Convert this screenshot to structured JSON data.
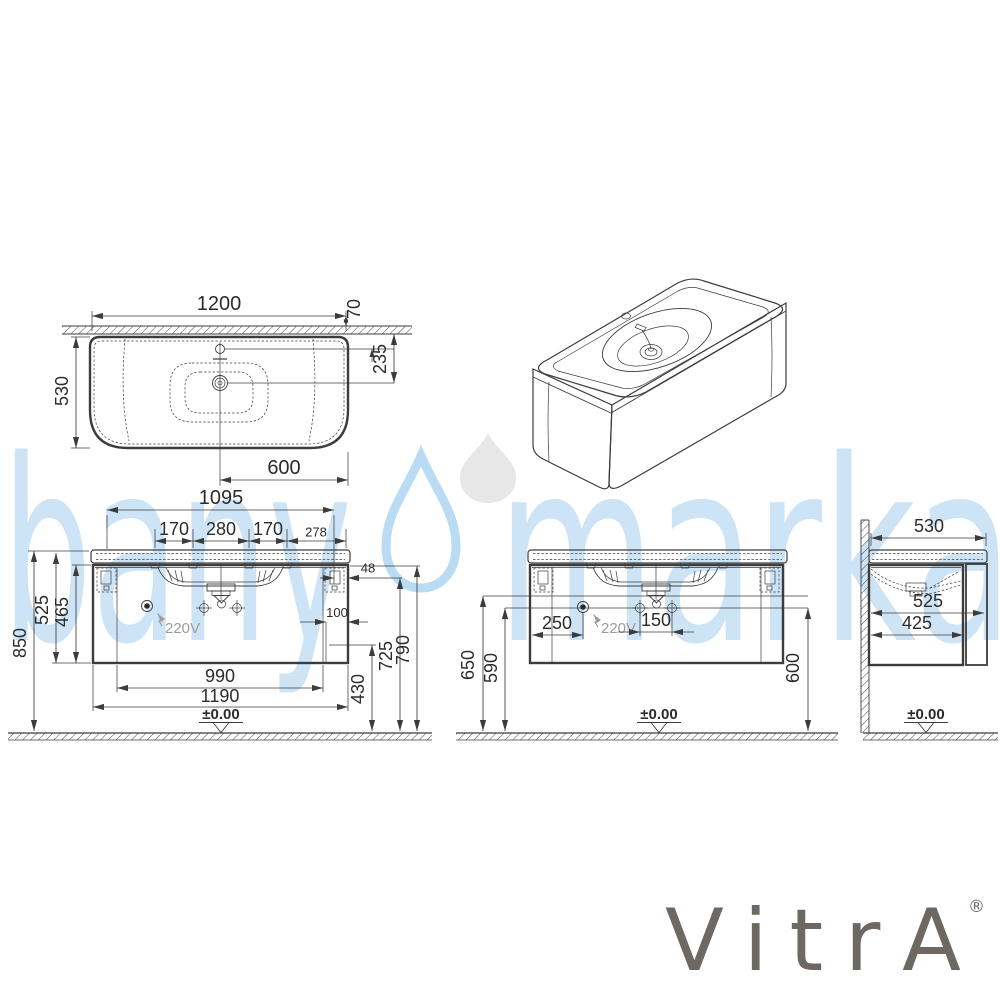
{
  "watermark": {
    "left": "bany",
    "right": "marka"
  },
  "brand": {
    "name": "VitrA",
    "registered": "®"
  },
  "colors": {
    "line": "#3c3c3c",
    "dim_text": "#2b2b2b",
    "muted_text": "#9d9d9d",
    "watermark_blue": "#cde4f7",
    "watermark_drop_outline": "#b9dbf4",
    "watermark_drop_gray": "#e7e7e7",
    "logo_gray": "#6d6962"
  },
  "top_view": {
    "width": "1200",
    "rim_to_wall": "70",
    "depth": "530",
    "drain_to_wall": "235",
    "drain_to_edge": "600"
  },
  "front_view": {
    "fixing_span": "1095",
    "hole_left": "170",
    "hole_mid": "280",
    "hole_right": "170",
    "hole_to_edge": "278",
    "edge_gap": "48",
    "recess": "100",
    "height_floor_to_top": "850",
    "height_unit": "525",
    "height_cabinet": "465",
    "h_430": "430",
    "h_725": "725",
    "h_790": "790",
    "inner_width": "990",
    "cabinet_width": "1190",
    "outlet_label": "220V",
    "datum": "±0.00"
  },
  "install_view": {
    "outlet_offset": "250",
    "screw_spacing": "150",
    "h_650": "650",
    "h_590": "590",
    "h_600": "600",
    "outlet_label": "220V",
    "datum": "±0.00"
  },
  "side_view": {
    "top_depth": "530",
    "total_depth": "525",
    "cabinet_depth": "425",
    "datum": "±0.00"
  }
}
